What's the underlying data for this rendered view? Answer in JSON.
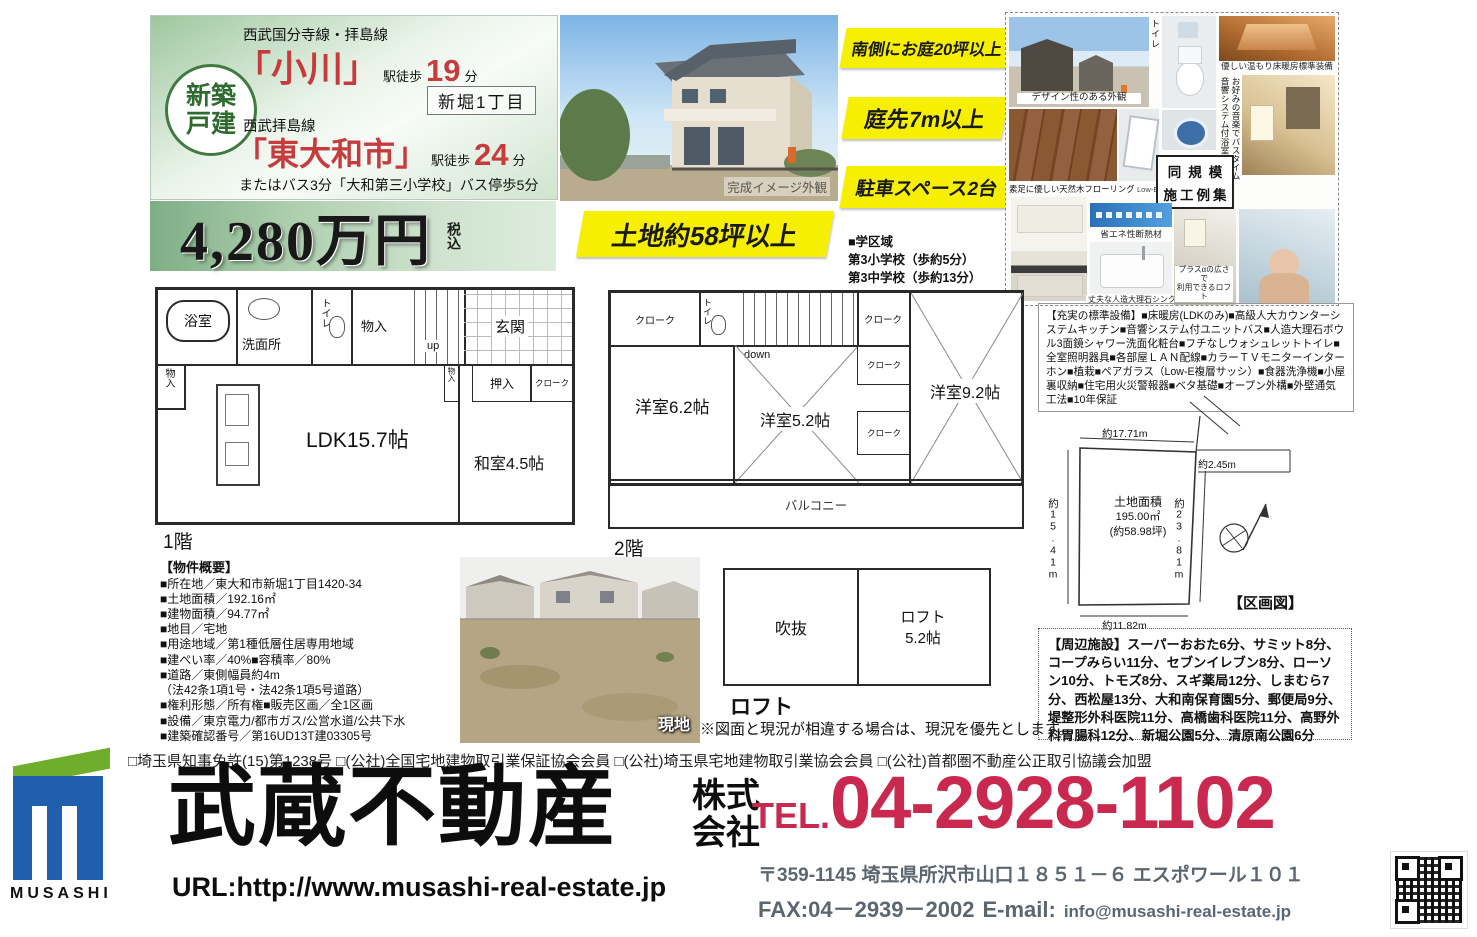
{
  "access": {
    "badge_line1": "新築",
    "badge_line2": "戸建",
    "line1": "西武国分寺線・拝島線",
    "station1": "「小川」",
    "walk_label": "駅徒歩",
    "walk1_min": "19",
    "min_unit": "分",
    "area_tag": "新堀1丁目",
    "line2": "西武拝島線",
    "station2": "「東大和市」",
    "walk2_min": "24",
    "bus_note": "またはバス3分「大和第三小学校」バス停歩5分"
  },
  "price": {
    "amount": "4,280万円",
    "tax_note": "税込"
  },
  "highlights": {
    "b1": "南側にお庭20坪以上",
    "b2": "庭先7m以上",
    "b3": "駐車スペース2台",
    "land": "土地約58坪以上"
  },
  "school": {
    "title": "■学区域",
    "item1": "第3小学校（歩約5分）",
    "item2": "第3中学校（歩約13分）"
  },
  "main_photo": {
    "caption": "完成イメージ外観"
  },
  "gallery": {
    "cap_exterior": "デザイン性のある外観",
    "cap_toilet": "お手入れ簡単節水トイレ",
    "cap_heating": "優しい温もり床暖房標準装備",
    "cap_audio1": "音響システム付浴室で",
    "cap_audio2": "お好みの音楽でバスタイム",
    "cap_flooring": "素足に優しい天然木フローリング",
    "cap_sash": "Low-E複層サッシ",
    "example_line1": "同規模",
    "example_line2": "施工例集",
    "cap_insulation": "省エネ性断熱材",
    "cap_sink": "丈夫な人造大理石シンク",
    "cap_loft1": "プラスαの広さで",
    "cap_loft2": "利用できるロフト"
  },
  "equipment": {
    "text": "【充実の標準設備】■床暖房(LDKのみ)■高級人大カウンターシステムキッチン■音響システム付ユニットバス■人造大理石ボウル3面鏡シャワー洗面化粧台■フチなしウォシュレットトイレ■全室照明器具■各部屋ＬＡＮ配線■カラーＴＶモニターインターホン■植栽■ペアガラス（Low-E複層サッシ）■食器洗浄機■小屋裏収納■住宅用火災警報器■ベタ基礎■オープン外構■外壁通気工法■10年保証"
  },
  "floor1": {
    "label": "1階",
    "bath": "浴室",
    "wash": "洗面所",
    "toilet": "トイレ",
    "storage": "物入",
    "up": "up",
    "entrance": "玄関",
    "ldk": "LDK15.7帖",
    "washitsu": "和室4.5帖",
    "oshiire": "押入",
    "closet": "クローク"
  },
  "floor2": {
    "label": "2階",
    "closet": "クローク",
    "toilet": "トイレ",
    "down": "down",
    "room62": "洋室6.2帖",
    "room52": "洋室5.2帖",
    "room92": "洋室9.2帖",
    "balcony": "バルコニー"
  },
  "loft": {
    "label": "ロフト",
    "void": "吹抜",
    "room_line1": "ロフト",
    "room_line2": "5.2帖",
    "note": "※図面と現況が相違する場合は、現況を優先とします。"
  },
  "outline": {
    "title": "【物件概要】",
    "lines": [
      "■所在地／東大和市新堀1丁目1420-34",
      "■土地面積／192.16㎡",
      "■建物面積／94.77㎡",
      "■地目／宅地",
      "■用途地域／第1種低層住居専用地域",
      "■建ぺい率／40%■容積率／80%",
      "■道路／東側幅員約4m",
      "（法42条1項1号・法42条1項5号道路）",
      "■権利形態／所有権■販売区画／全1区画",
      "■設備／東京電力/都市ガス/公営水道/公共下水",
      "■建築確認番号／第16UD13T建03305号"
    ]
  },
  "site_photo": {
    "label": "現地"
  },
  "plot": {
    "title": "【区画図】",
    "area_title": "土地面積",
    "area_m2": "195.00㎡",
    "area_tsubo": "(約58.98坪)",
    "len_top": "約17.71m",
    "len_left": "約15.41m",
    "len_right": "約23.81m",
    "len_bottom": "約11.82m",
    "len_notch": "約2.45m"
  },
  "surroundings": {
    "text": "【周辺施設】スーパーおおた6分、サミット8分、コープみらい11分、セブンイレブン8分、ローソン10分、トモズ8分、スギ薬局12分、しまむら7分、西松屋13分、大和南保育園5分、郵便局9分、堤整形外科医院11分、高橋歯科医院11分、高野外科胃腸科12分、新堀公園5分、清原南公園6分"
  },
  "footer": {
    "license": "□埼玉県知事免許(15)第1238号 □(公社)全国宅地建物取引業保証協会会員 □(公社)埼玉県宅地建物取引業協会会員 □(公社)首都圏不動産公正取引協議会加盟",
    "logo_text": "MUSASHI",
    "company": "武蔵不動産",
    "company_type1": "株式",
    "company_type2": "会社",
    "url": "URL:http://www.musashi-real-estate.jp",
    "tel_label": "TEL.",
    "tel_number": "04-2928-1102",
    "address": "〒359-1145 埼玉県所沢市山口１８５１－６ エスポワール１０１",
    "fax": "FAX:04－2939－2002",
    "email_label": "E-mail:",
    "email": "info@musashi-real-estate.jp"
  },
  "colors": {
    "accent_red": "#c9294e",
    "station_red": "#c63c3c",
    "brand_blue": "#1f5fad",
    "brand_green": "#6fae2c",
    "highlight_yellow": "#f7ef00",
    "theme_green": "#9ec79e"
  }
}
